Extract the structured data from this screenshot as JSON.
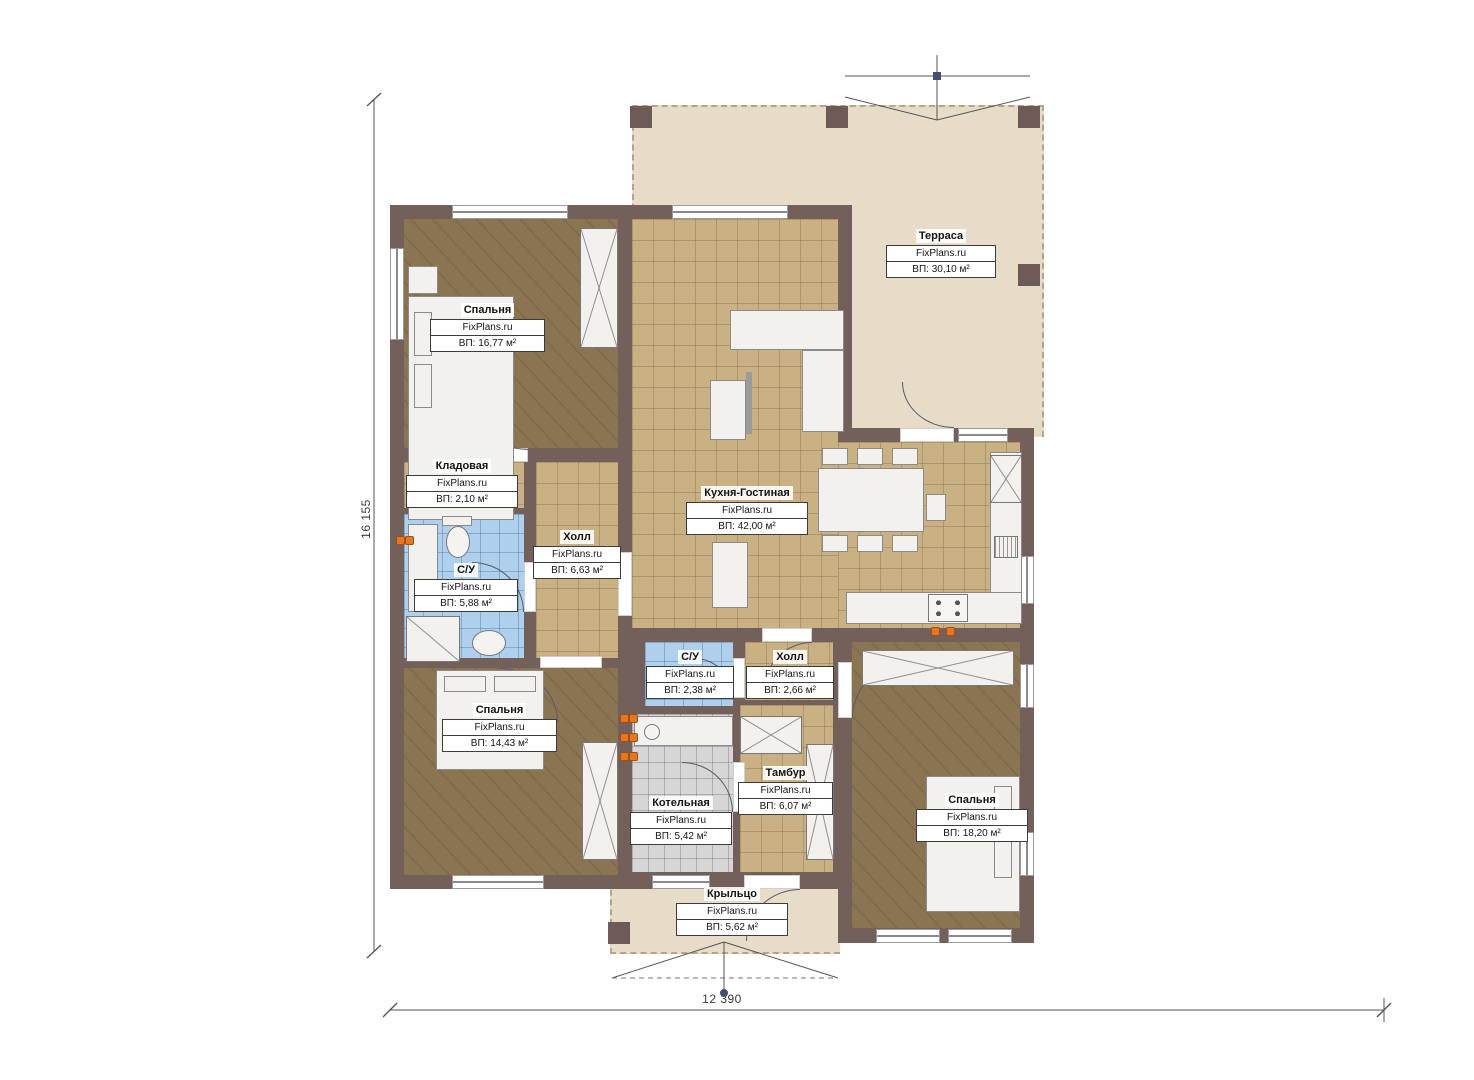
{
  "plan": {
    "watermark": "FixPlans.ru",
    "dimensions": {
      "height": "16 155",
      "width": "12 390"
    },
    "rooms": [
      {
        "id": "terrace",
        "name": "Терраса",
        "area": "ВП: 30,10 м²"
      },
      {
        "id": "bedroom-1",
        "name": "Спальня",
        "area": "ВП: 16,77 м²"
      },
      {
        "id": "storage",
        "name": "Кладовая",
        "area": "ВП: 2,10 м²"
      },
      {
        "id": "bathroom-1",
        "name": "С/У",
        "area": "ВП: 5,88 м²"
      },
      {
        "id": "hall-1",
        "name": "Холл",
        "area": "ВП: 6,63 м²"
      },
      {
        "id": "kitchen-living",
        "name": "Кухня-Гостиная",
        "area": "ВП: 42,00 м²"
      },
      {
        "id": "bathroom-2",
        "name": "С/У",
        "area": "ВП: 2,38 м²"
      },
      {
        "id": "hall-2",
        "name": "Холл",
        "area": "ВП: 2,66 м²"
      },
      {
        "id": "bedroom-2",
        "name": "Спальня",
        "area": "ВП: 14,43 м²"
      },
      {
        "id": "boiler-room",
        "name": "Котельная",
        "area": "ВП: 5,42 м²"
      },
      {
        "id": "vestibule",
        "name": "Тамбур",
        "area": "ВП: 6,07 м²"
      },
      {
        "id": "bedroom-3",
        "name": "Спальня",
        "area": "ВП: 18,20 м²"
      },
      {
        "id": "porch",
        "name": "Крыльцо",
        "area": "ВП: 5,62 м²"
      }
    ],
    "colors": {
      "wall": "#74605b",
      "wood_floor": "#8a7452",
      "tile_tan": "#c9b183",
      "tile_blue": "#aed0ec",
      "tile_gray": "#d6d6d6",
      "outdoor": "#e7dcc8",
      "radiator_accent": "#e8761f"
    }
  }
}
